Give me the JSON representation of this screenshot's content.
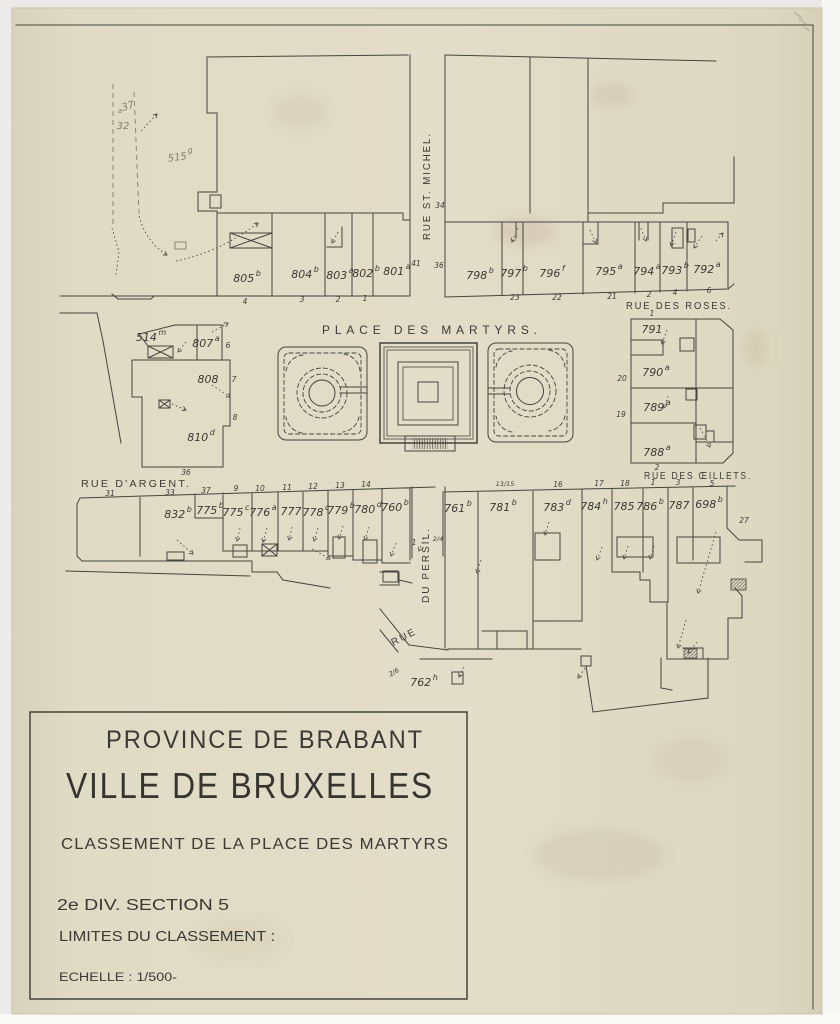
{
  "colors": {
    "paper": "#e0dbc5",
    "ink": "#45443e",
    "pencil": "#8d8577",
    "background": "#ebeae8"
  },
  "title_block": {
    "region": "PROVINCE DE BRABANT",
    "city": "VILLE DE BRUXELLES",
    "subject": "CLASSEMENT DE LA PLACE DES MARTYRS",
    "division": "2e DIV.  SECTION 5",
    "limits": "LIMITES DU CLASSEMENT :",
    "scale": "ECHELLE : 1/500-"
  },
  "place": {
    "label": "PLACE DES MARTYRS."
  },
  "streets": {
    "st_michel": "RUE ST. MICHEL.",
    "roses": "RUE DES ROSES.",
    "oeillets": "RUE DES ŒILLETS.",
    "argent": "RUE D'ARGENT.",
    "persil_line1": "RUE",
    "persil_line2": "DU PERSIL."
  },
  "parcels": {
    "north_row": [
      {
        "num": "805",
        "sup": "b"
      },
      {
        "num": "804",
        "sup": "b"
      },
      {
        "num": "803",
        "sup": "a"
      },
      {
        "num": "802",
        "sup": "b"
      },
      {
        "num": "801",
        "sup": "a"
      }
    ],
    "northeast_row": [
      {
        "num": "798",
        "sup": "b"
      },
      {
        "num": "797",
        "sup": "b"
      },
      {
        "num": "796",
        "sup": "f"
      },
      {
        "num": "795",
        "sup": "a"
      },
      {
        "num": "794",
        "sup": "a"
      },
      {
        "num": "793",
        "sup": "b"
      },
      {
        "num": "792",
        "sup": "a"
      }
    ],
    "east_block": [
      {
        "num": "791"
      },
      {
        "num": "790",
        "sup": "a"
      },
      {
        "num": "789",
        "sup": "a"
      },
      {
        "num": "788",
        "sup": "a"
      }
    ],
    "west_block": [
      {
        "num": "514",
        "sup": "m"
      },
      {
        "num": "807",
        "sup": "a"
      },
      {
        "num": "808"
      },
      {
        "num": "810",
        "sup": "d"
      }
    ],
    "southwest_row": [
      {
        "num": "832",
        "sup": "b"
      },
      {
        "num": "775",
        "sup": "b"
      },
      {
        "num": "775",
        "sup": "c"
      },
      {
        "num": "776",
        "sup": "a"
      },
      {
        "num": "777"
      },
      {
        "num": "778",
        "sup": "c"
      },
      {
        "num": "779",
        "sup": "b"
      },
      {
        "num": "780",
        "sup": "d"
      },
      {
        "num": "760",
        "sup": "b"
      }
    ],
    "southeast_row": [
      {
        "num": "761",
        "sup": "b"
      },
      {
        "num": "781",
        "sup": "b"
      },
      {
        "num": "783",
        "sup": "d"
      },
      {
        "num": "784",
        "sup": "h"
      },
      {
        "num": "785"
      },
      {
        "num": "786",
        "sup": "b"
      },
      {
        "num": "787"
      },
      {
        "num": "698",
        "sup": "b"
      }
    ],
    "south": [
      {
        "num": "762",
        "sup": "h"
      }
    ],
    "pencil_northwest": [
      {
        "num": "515",
        "sup": "g"
      },
      {
        "num": "37",
        "sup": "a"
      },
      {
        "num": "32"
      }
    ]
  },
  "house_numbers": {
    "north_row": [
      "4",
      "3",
      "2",
      "1"
    ],
    "st_michel_west": "41",
    "st_michel_east": [
      "34",
      "36"
    ],
    "northeast_row": [
      "23",
      "22",
      "21",
      "2",
      "4",
      "6"
    ],
    "roses_corner": "1",
    "east_block_west": [
      "20",
      "19"
    ],
    "east_block_south": "2",
    "west_block_east": [
      "6",
      "7",
      "8"
    ],
    "argent_north": "36",
    "argent_south": [
      "31",
      "33",
      "37",
      "9",
      "10",
      "11",
      "12",
      "13",
      "14"
    ],
    "oeillets_row": [
      "13/15",
      "16",
      "17",
      "18",
      "1",
      "3",
      "5"
    ],
    "east_27": "27",
    "persil_1": "1",
    "persil_frac": "2/4",
    "rue_frac": "2/6"
  }
}
